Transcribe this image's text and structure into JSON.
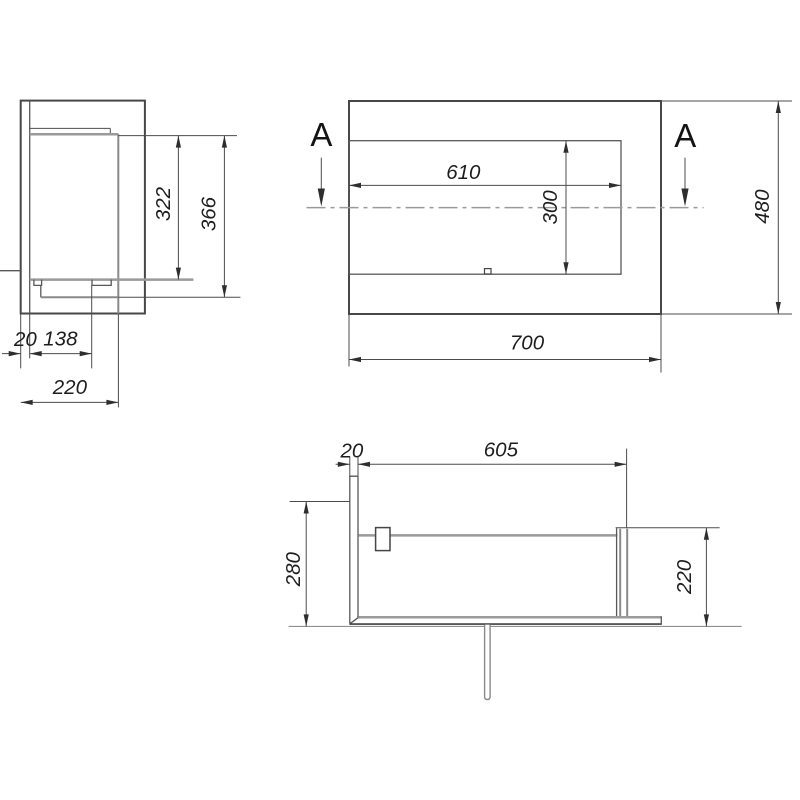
{
  "drawing": {
    "section_marks": {
      "left": "A",
      "right": "A"
    },
    "side_view": {
      "dim_firebox_height": "322",
      "dim_inner_height": "366",
      "dim_wall_thickness": "20",
      "dim_burner_offset": "138",
      "dim_depth": "220"
    },
    "front_view": {
      "dim_opening_width": "610",
      "dim_opening_height": "300",
      "dim_overall_width": "700",
      "dim_overall_height": "480"
    },
    "section_view": {
      "dim_wall_thickness": "20",
      "dim_inner_width": "605",
      "dim_overall_depth": "280",
      "dim_inner_depth": "220"
    },
    "colors": {
      "background": "#ffffff",
      "outline": "#474747",
      "secondary_gray": "#9a9a9a",
      "dimension_text": "#1d1d1d"
    }
  }
}
